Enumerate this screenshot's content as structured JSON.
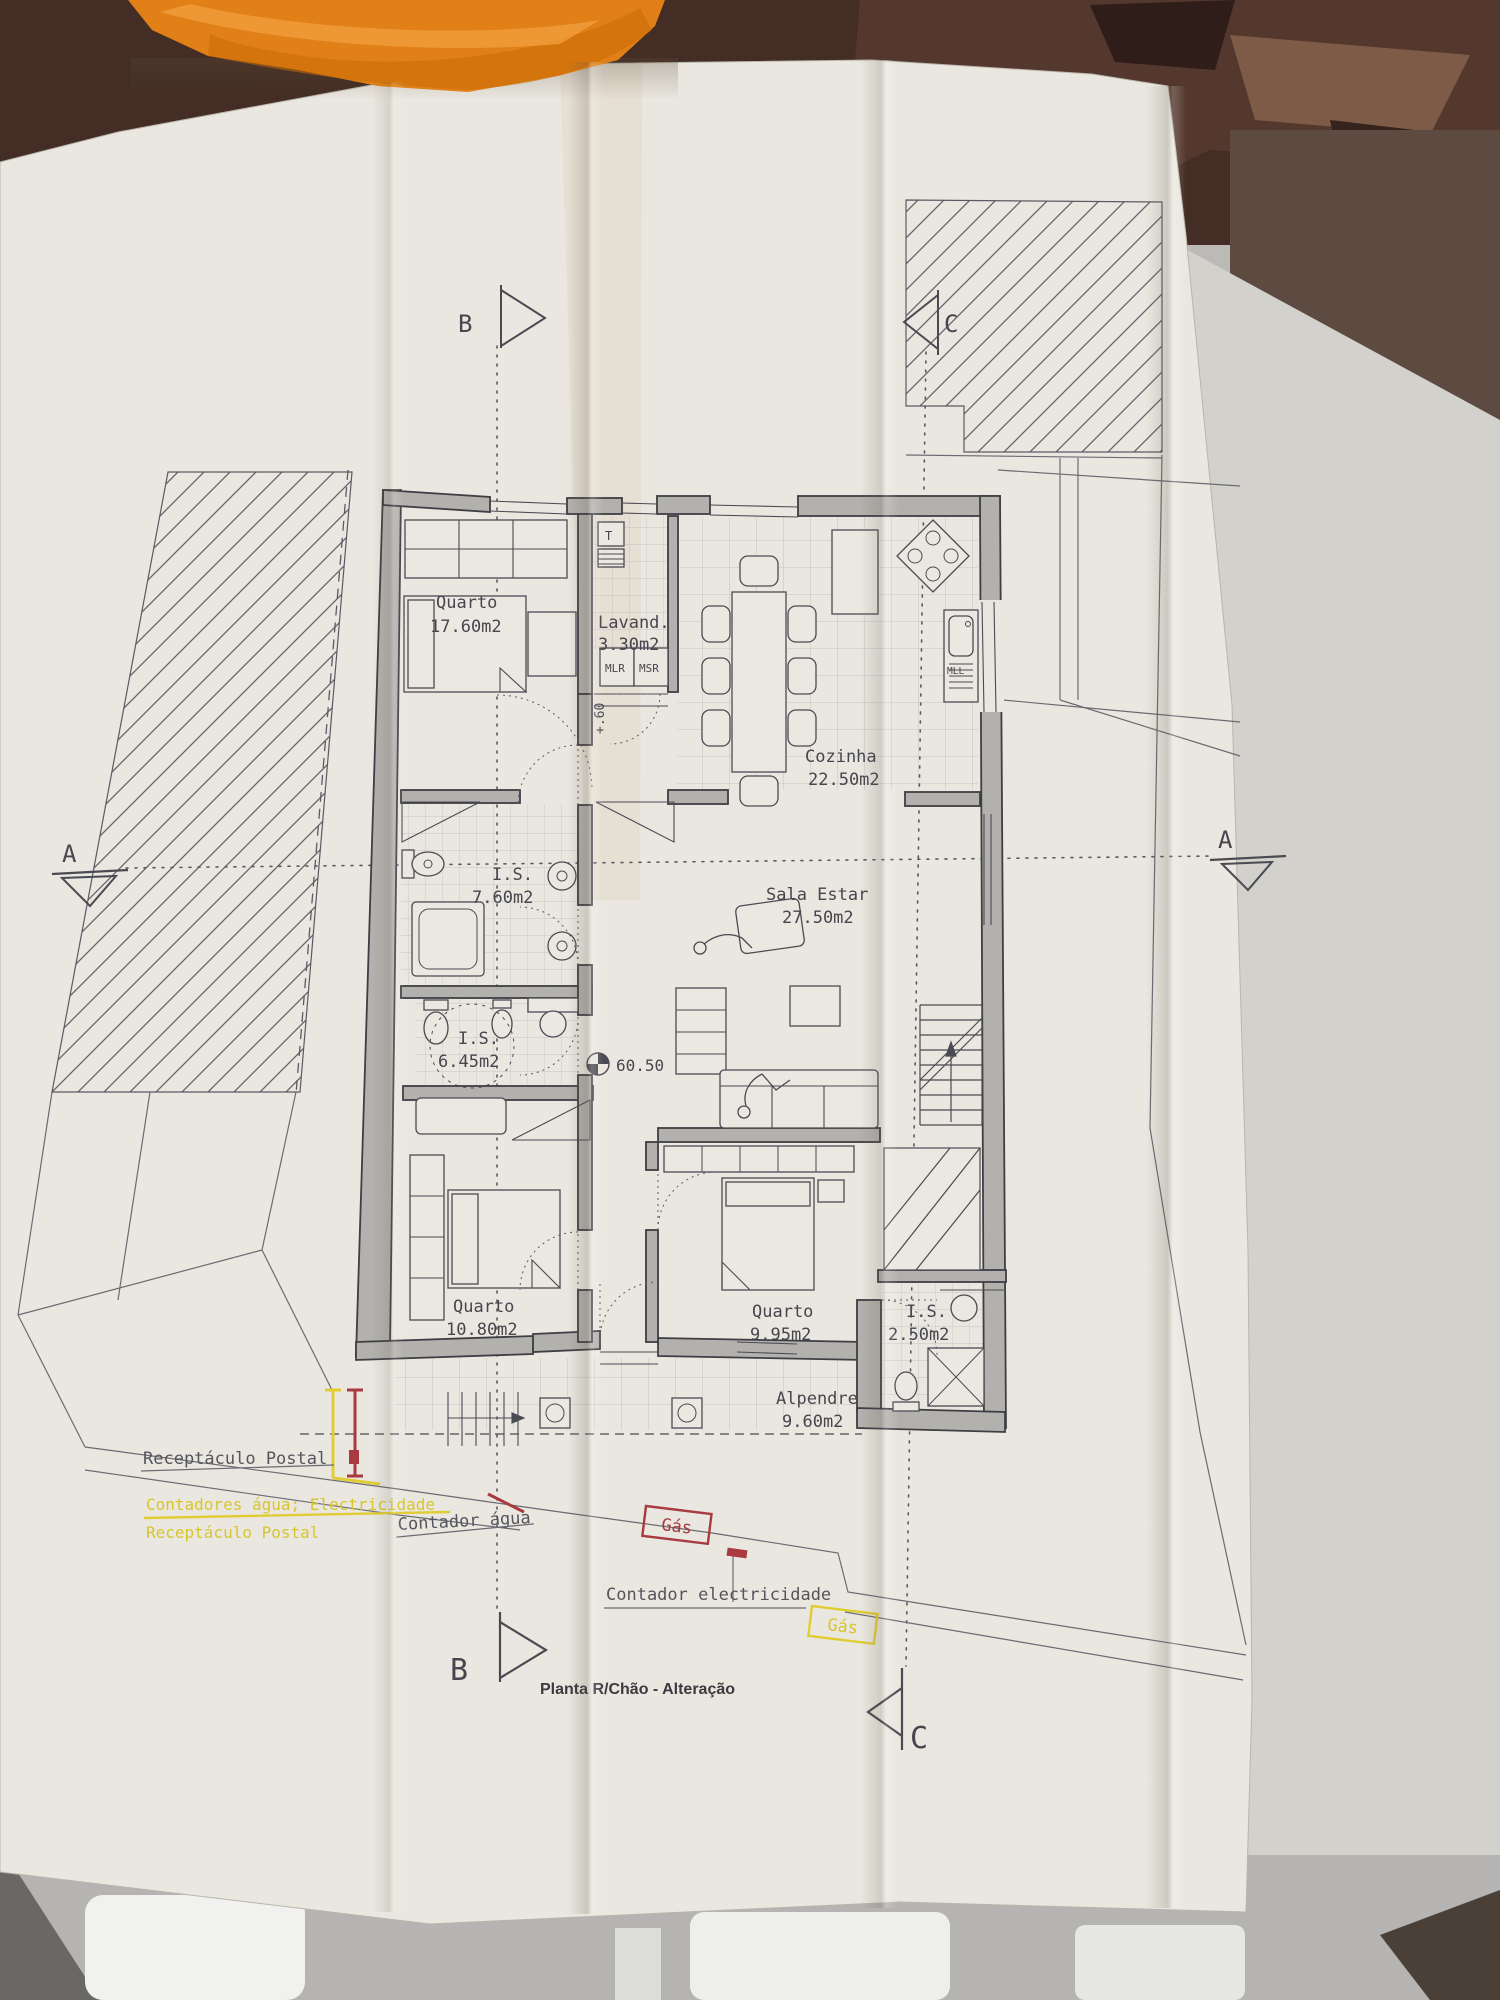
{
  "title": "Planta R/Chão - Alteração",
  "rooms": {
    "quarto1": {
      "name": "Quarto",
      "area": "17.60m2"
    },
    "lavandaria": {
      "name": "Lavand.",
      "area": "3.30m2"
    },
    "cozinha": {
      "name": "Cozinha",
      "area": "22.50m2"
    },
    "is1": {
      "name": "I.S.",
      "area": "7.60m2"
    },
    "sala": {
      "name": "Sala Estar",
      "area": "27.50m2"
    },
    "is2": {
      "name": "I.S.",
      "area": "6.45m2"
    },
    "quarto2": {
      "name": "Quarto",
      "area": "10.80m2"
    },
    "quarto3": {
      "name": "Quarto",
      "area": "9.95m2"
    },
    "is3": {
      "name": "I.S.",
      "area": "2.50m2"
    },
    "alpendre": {
      "name": "Alpendre",
      "area": "9.60m2"
    }
  },
  "equipment": {
    "t": "T",
    "mlr": "MLR",
    "msr": "MSR",
    "mll": "MLL"
  },
  "levels": {
    "floor": "60.50",
    "step": "+.60"
  },
  "sections": {
    "a": "A",
    "b": "B",
    "c": "C"
  },
  "annotations": {
    "postal_existing": "Receptáculo Postal",
    "meters_new": "Contadores água; Electricidade",
    "postal_new": "Receptáculo Postal",
    "water_meter": "Contador água",
    "electricity_meter": "Contador electricidade",
    "gas_label_1": "Gás",
    "gas_label_2": "Gás"
  },
  "colors": {
    "paper": "#eae7e0",
    "ink": "#4a4a52",
    "wall_fill": "#b3b1ad",
    "highlight_yellow": "#ddc72f",
    "highlight_red": "#a83a40",
    "towel_orange": "#e08016",
    "background_brown": "#432d24"
  }
}
